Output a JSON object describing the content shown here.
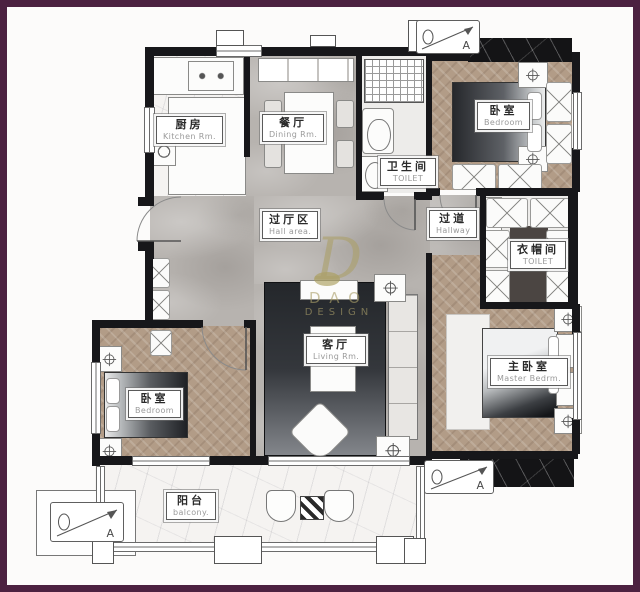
{
  "rooms": {
    "kitchen": {
      "zh": "厨房",
      "en": "Kitchen Rm."
    },
    "dining": {
      "zh": "餐厅",
      "en": "Dining Rm."
    },
    "bathroom": {
      "zh": "卫生间",
      "en": "TOILET"
    },
    "bedroom_top": {
      "zh": "卧室",
      "en": "Bedroom"
    },
    "hall": {
      "zh": "过厅区",
      "en": "Hall area."
    },
    "hallway": {
      "zh": "过道",
      "en": "Hallway"
    },
    "cloakroom": {
      "zh": "衣帽间",
      "en": "TOILET"
    },
    "living": {
      "zh": "客厅",
      "en": "Living Rm."
    },
    "bedroom_left": {
      "zh": "卧室",
      "en": "Bedroom"
    },
    "master": {
      "zh": "主卧室",
      "en": "Master Bedrm."
    },
    "balcony": {
      "zh": "阳台",
      "en": "balcony."
    }
  },
  "markers": {
    "top": "A",
    "bottom_right": "A",
    "bottom_left": "A"
  },
  "watermark": {
    "monogram": "D",
    "line1": "DAO",
    "line2": "DESIGN"
  },
  "colors": {
    "frame": "#4c2140",
    "grey_marble": "#b7b3af",
    "white_marble": "#f5f3f1",
    "wood_floor": "#b29c87",
    "dark_floor": "#4b4542",
    "black_marble": "#141416",
    "watermark_gold": "#aba06a"
  }
}
